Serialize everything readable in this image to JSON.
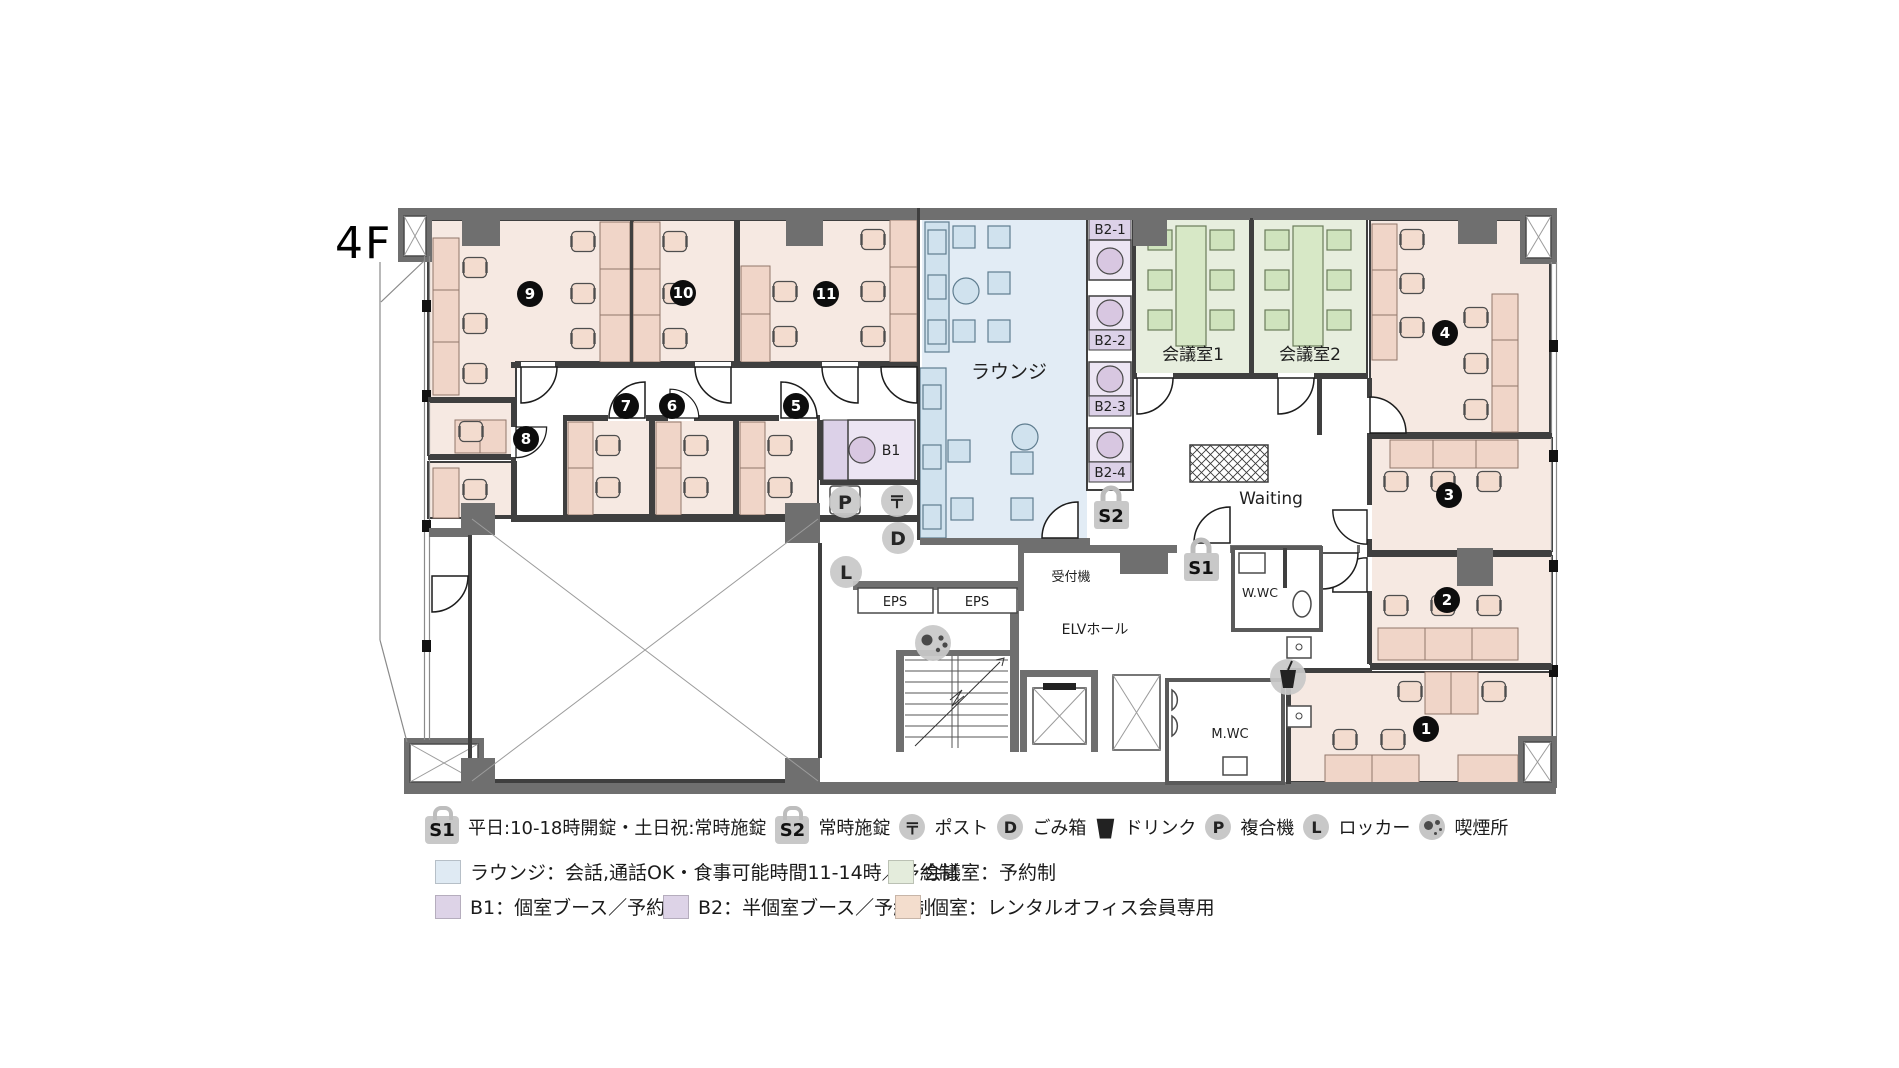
{
  "floor_label": "4F",
  "rooms": {
    "private": [
      "1",
      "2",
      "3",
      "4",
      "5",
      "6",
      "7",
      "8",
      "9",
      "10",
      "11"
    ]
  },
  "labels": {
    "lounge": "ラウンジ",
    "meeting1": "会議室1",
    "meeting2": "会議室2",
    "waiting": "Waiting",
    "reception": "受付機",
    "elv_hall": "ELVホール",
    "womens_wc": "W.WC",
    "mens_wc": "M.WC",
    "eps": "EPS",
    "b1": "B1",
    "b2_1": "B2-1",
    "b2_2": "B2-2",
    "b2_3": "B2-3",
    "b2_4": "B2-4",
    "s1": "S1",
    "s2": "S2",
    "post_mark": "〒",
    "trash_mark": "D",
    "copier_mark": "P",
    "locker_mark": "L"
  },
  "legend": {
    "s1_label": "S1",
    "s1_text": "平日:10-18時開錠・土日祝:常時施錠",
    "s2_label": "S2",
    "s2_text": "常時施錠",
    "post_label": "〒",
    "post_text": "ポスト",
    "trash_label": "D",
    "trash_text": "ごみ箱",
    "drink_text": "ドリンク",
    "copier_label": "P",
    "copier_text": "複合機",
    "locker_label": "L",
    "locker_text": "ロッカー",
    "smoking_text": "喫煙所",
    "lounge_text": "ラウンジ：会話,通話OK・食事可能時間11-14時／予約制",
    "meeting_text": "会議室：予約制",
    "b1_text": "B1：個室ブース／予約制",
    "b2_text": "B2：半個室ブース／予約制",
    "private_text": "個室：レンタルオフィス会員専用"
  },
  "colors": {
    "private_room": "#f6e9e2",
    "desk": "#f0d5c8",
    "lounge": "#e2ecf5",
    "meeting_room": "#e7eede",
    "booth": "#ece5f3",
    "wall": "#6f6f6f",
    "badge_gray": "#c8c8c8",
    "number_badge": "#0d0d0d"
  }
}
